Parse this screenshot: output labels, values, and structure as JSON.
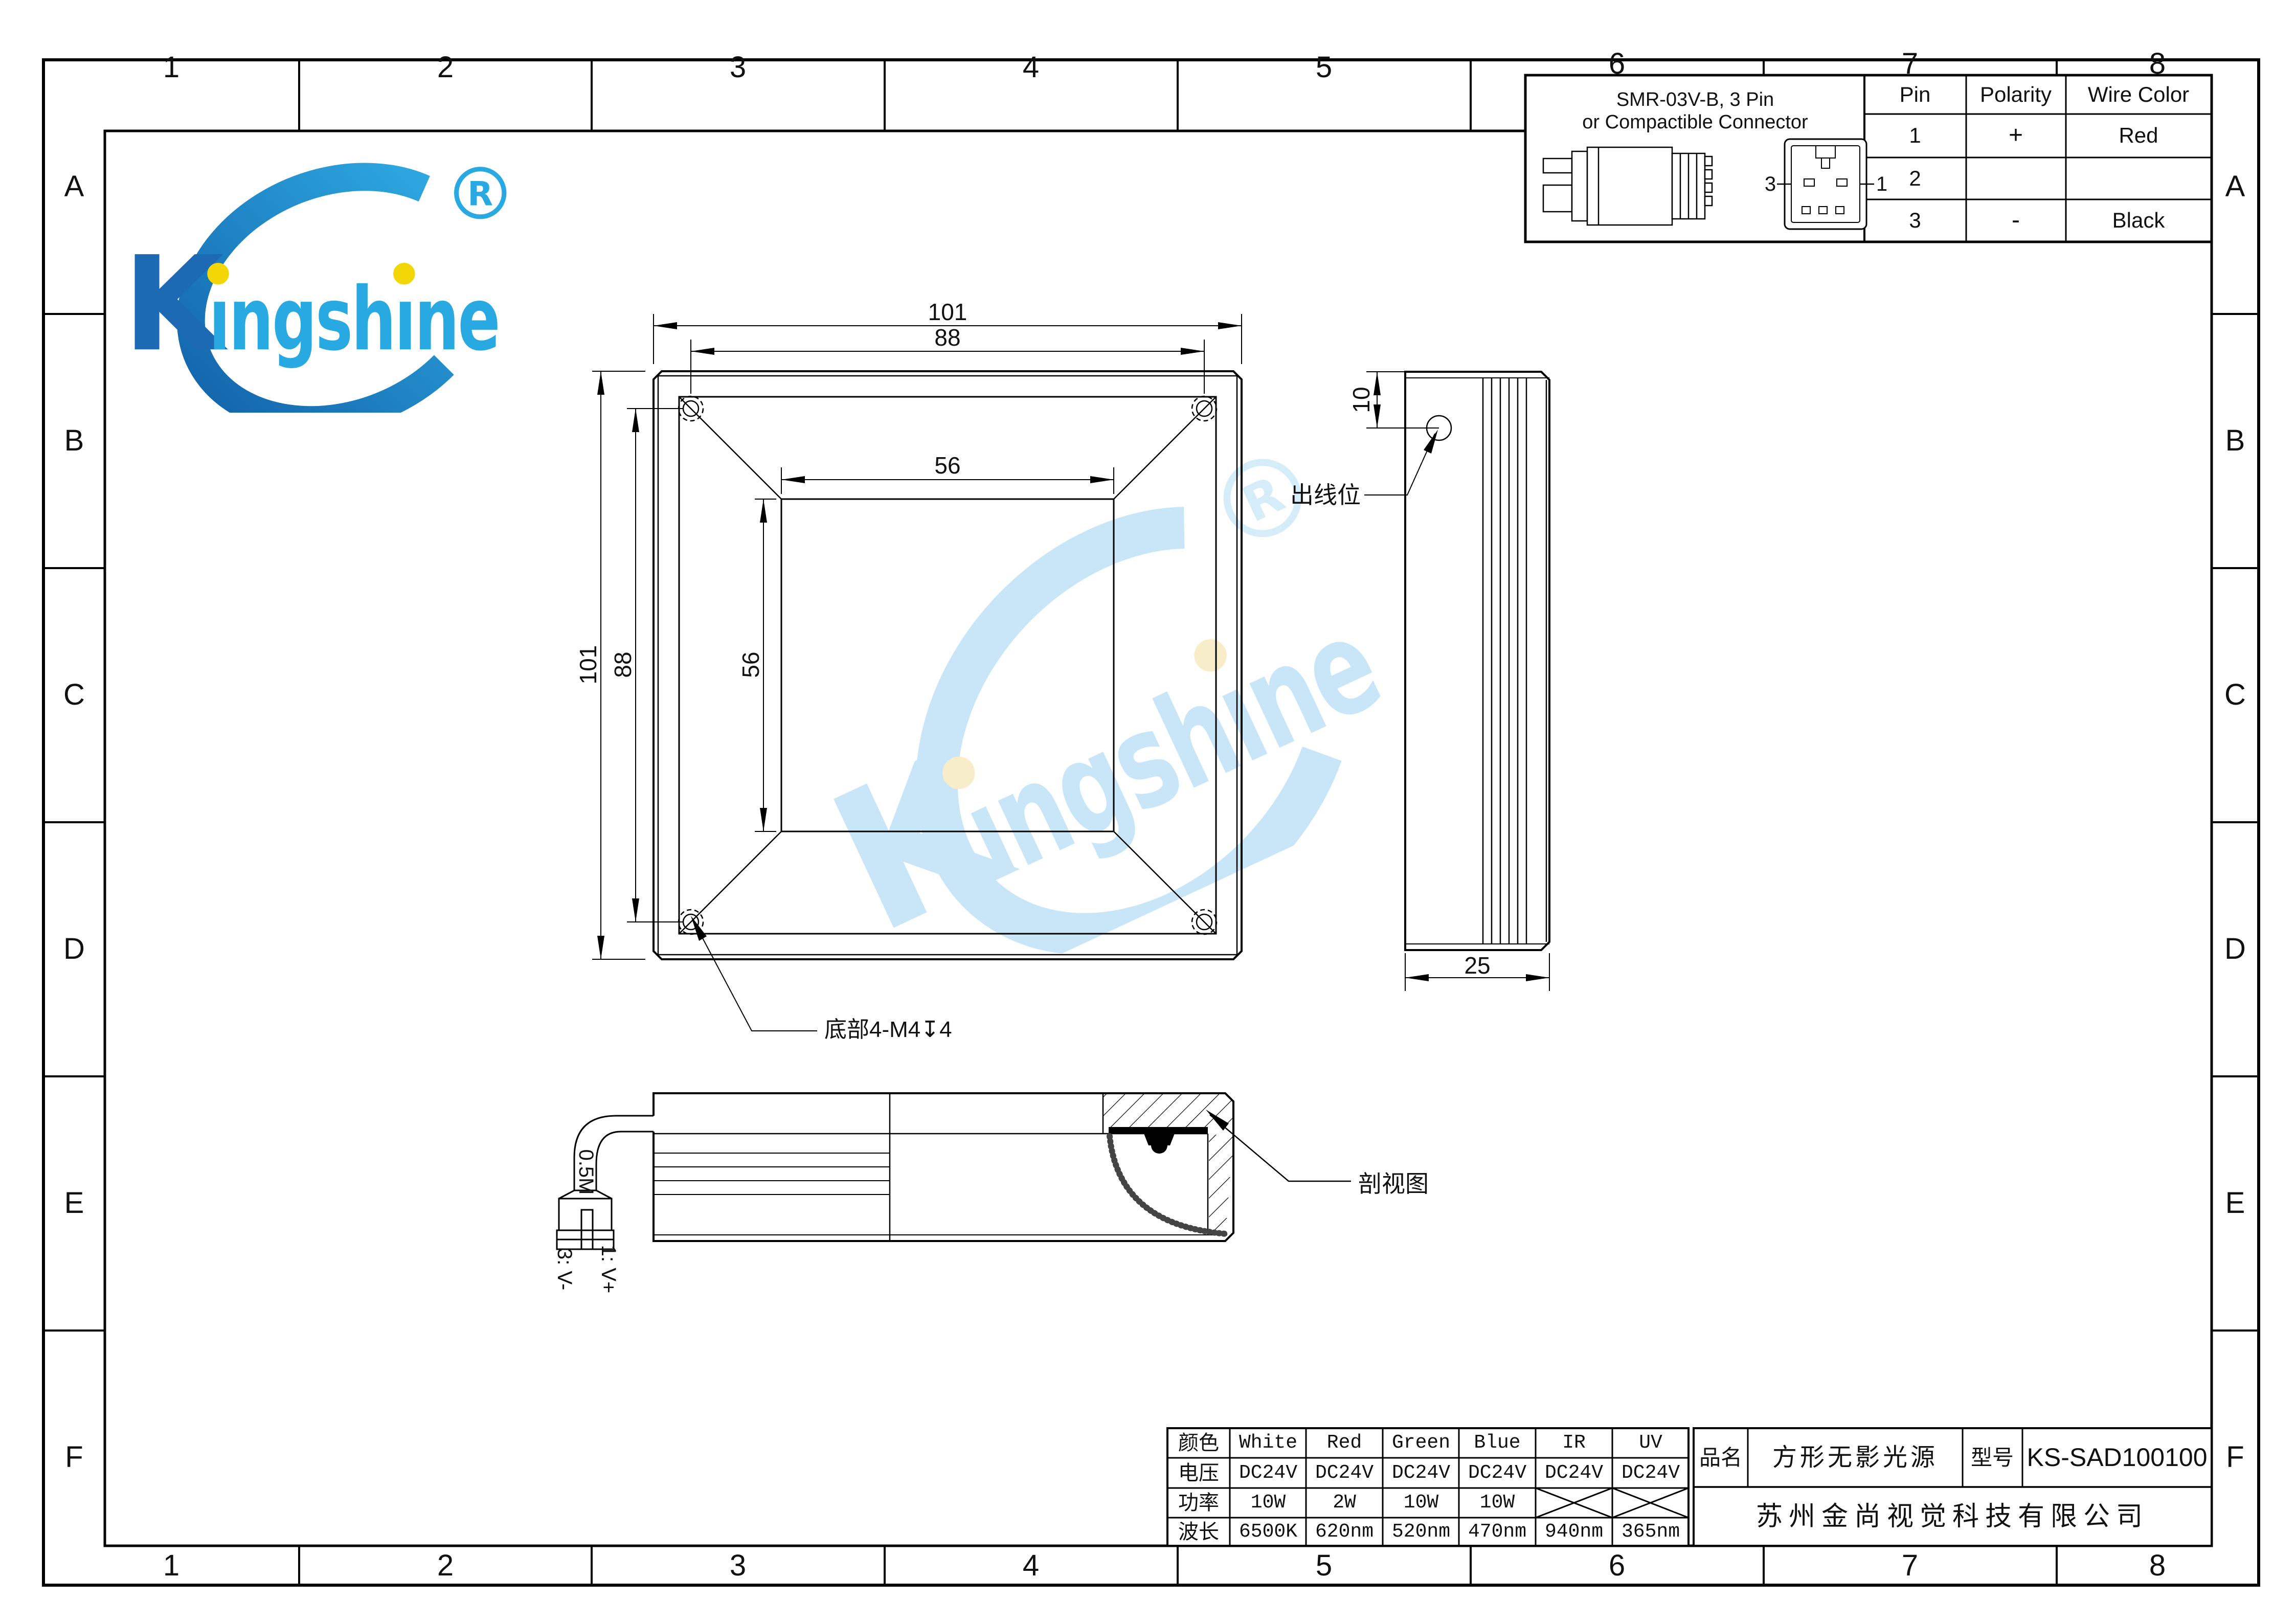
{
  "sheet": {
    "cols": [
      "1",
      "2",
      "3",
      "4",
      "5",
      "6",
      "7",
      "8"
    ],
    "rows": [
      "A",
      "B",
      "C",
      "D",
      "E",
      "F"
    ]
  },
  "logo": {
    "name": "Kingshine",
    "k": "K",
    "rest": "ıngshıne",
    "registered": "R",
    "accent_blue": "#29a9e2",
    "dark_blue": "#1261a8",
    "dot_yellow": "#f3d605"
  },
  "connector_panel": {
    "title_line1": "SMR-03V-B, 3 Pin",
    "title_line2": "or Compactible Connector",
    "left_pin_label": "3",
    "right_pin_label": "1",
    "pin_table": {
      "headers": [
        "Pin",
        "Polarity",
        "Wire Color"
      ],
      "rows": [
        [
          "1",
          "+",
          "Red"
        ],
        [
          "2",
          "",
          ""
        ],
        [
          "3",
          "-",
          "Black"
        ]
      ]
    }
  },
  "front_view": {
    "width_outer": "101",
    "width_holes": "88",
    "width_aperture": "56",
    "height_outer": "101",
    "height_holes": "88",
    "height_aperture": "56",
    "hole_note": "底部4-M4↧4"
  },
  "side_view": {
    "outlet_offset": "10",
    "thickness": "25",
    "outlet_label": "出线位"
  },
  "section_view": {
    "cable_length": "0.5M",
    "pin1": "1: V+",
    "pin3": "3: V-",
    "label": "剖视图"
  },
  "spec_table": {
    "row_headers": [
      "颜色",
      "电压",
      "功率",
      "波长"
    ],
    "colors": [
      "White",
      "Red",
      "Green",
      "Blue",
      "IR",
      "UV"
    ],
    "voltage": [
      "DC24V",
      "DC24V",
      "DC24V",
      "DC24V",
      "DC24V",
      "DC24V"
    ],
    "power": [
      "10W",
      "2W",
      "10W",
      "10W",
      "",
      ""
    ],
    "wavelength": [
      "6500K",
      "620nm",
      "520nm",
      "470nm",
      "940nm",
      "365nm"
    ]
  },
  "title_block": {
    "name_label": "品名",
    "product_name": "方形无影光源",
    "model_label": "型号",
    "model": "KS-SAD100100",
    "company": "苏州金尚视觉科技有限公司"
  }
}
